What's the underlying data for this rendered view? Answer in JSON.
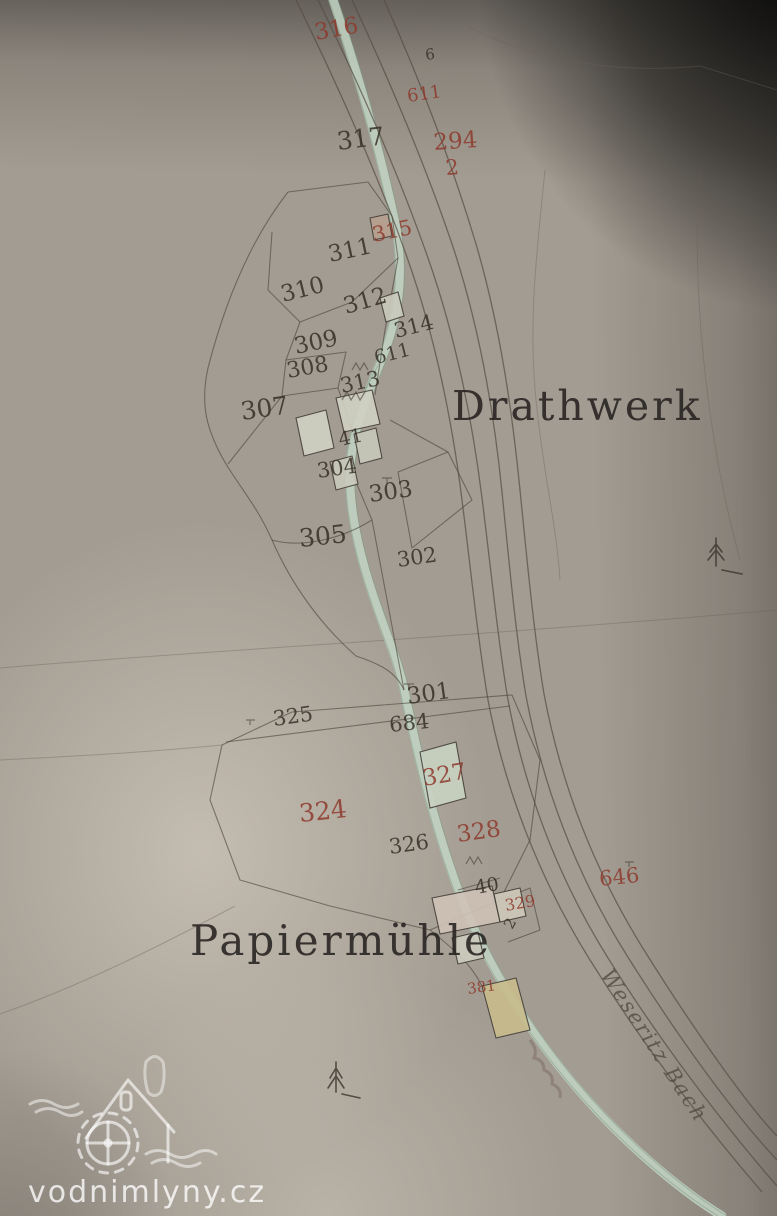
{
  "watermark": {
    "text": "vodnimlyny.cz"
  },
  "colors": {
    "paper": "#a39c92",
    "red_ink": "#8e3a2d",
    "black_ink": "#352e26",
    "stream": "#c2d5c4",
    "watermark_white": "#ffffff"
  },
  "map": {
    "labels": {
      "drathwerk": "Drathwerk",
      "papiermuehle": "Papiermühle",
      "stream": "Weseritz Bach"
    },
    "parcel_numbers_black": [
      {
        "label": "6"
      },
      {
        "label": "317"
      },
      {
        "label": "311"
      },
      {
        "label": "310"
      },
      {
        "label": "312"
      },
      {
        "label": "309"
      },
      {
        "label": "611"
      },
      {
        "label": "308"
      },
      {
        "label": "313"
      },
      {
        "label": "314"
      },
      {
        "label": "307"
      },
      {
        "label": "41"
      },
      {
        "label": "304"
      },
      {
        "label": "303"
      },
      {
        "label": "305"
      },
      {
        "label": "302"
      },
      {
        "label": "301"
      },
      {
        "label": "325"
      },
      {
        "label": "684"
      },
      {
        "label": "326"
      },
      {
        "label": "40"
      },
      {
        "label": "2"
      }
    ],
    "parcel_numbers_red": [
      {
        "label": "316"
      },
      {
        "label": "611"
      },
      {
        "label": "294"
      },
      {
        "label": "2"
      },
      {
        "label": "315"
      },
      {
        "label": "327"
      },
      {
        "label": "324"
      },
      {
        "label": "328"
      },
      {
        "label": "329"
      },
      {
        "label": "646"
      },
      {
        "label": "381"
      }
    ]
  }
}
